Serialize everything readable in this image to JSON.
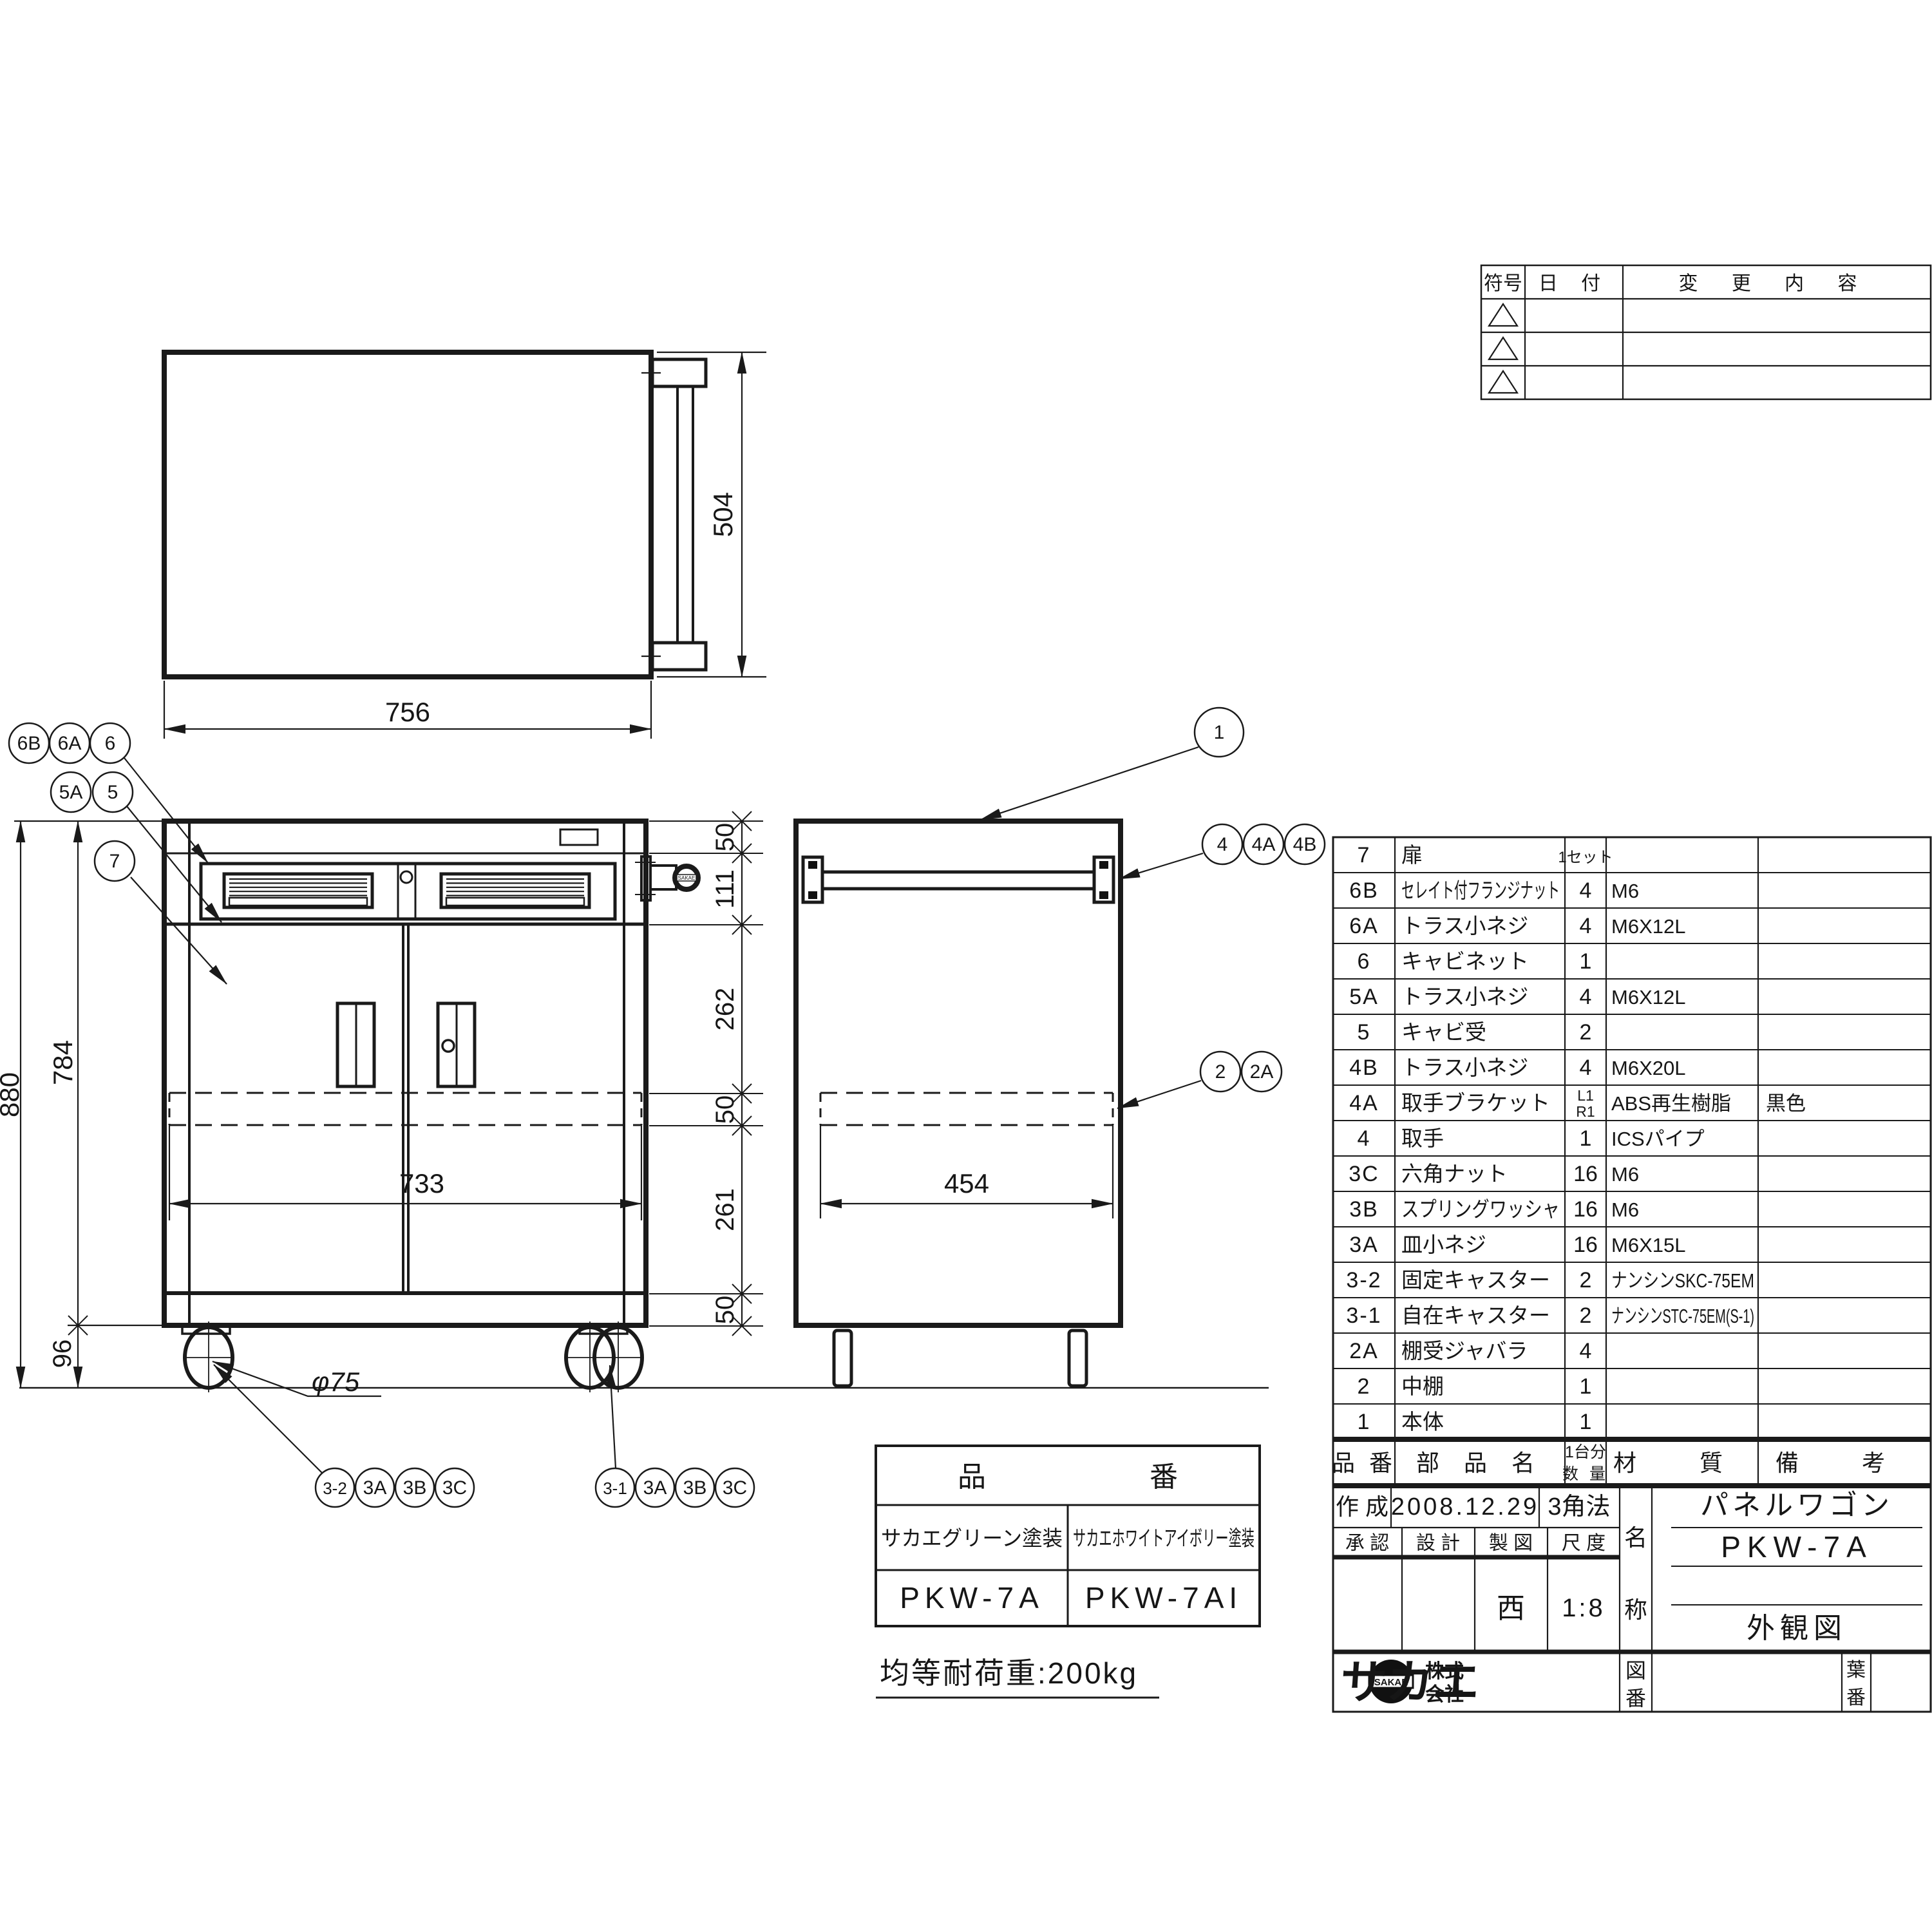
{
  "document": {
    "type": "engineering-drawing",
    "product_name": "パネルワゴン",
    "model": "PKW-7A",
    "sheet_title": "外観図"
  },
  "dimensions": {
    "top_width": "756",
    "top_depth": "504",
    "overall_height": "880",
    "body_height": "784",
    "caster_height": "96",
    "door_width": "733",
    "shelf_depth": "454",
    "caster_dia": "φ75",
    "right_chain": [
      "50",
      "111",
      "262",
      "50",
      "261",
      "50"
    ]
  },
  "callouts": [
    "6B",
    "6A",
    "6",
    "5A",
    "5",
    "7",
    "1",
    "4",
    "4A",
    "4B",
    "2",
    "2A",
    "3-2",
    "3A",
    "3B",
    "3C",
    "3-1",
    "3A",
    "3B",
    "3C"
  ],
  "revision_table": {
    "col_symbol": "符号",
    "col_date": "日 付",
    "col_change": "変 更 内 容",
    "empty_rows": 3
  },
  "parts_table": {
    "header": {
      "no": "品 番",
      "name": "部 品 名",
      "qty_line1": "1台分",
      "qty_line2": "数 量",
      "material": "材 質",
      "remarks": "備 考"
    },
    "rows": [
      {
        "no": "7",
        "name": "扉",
        "qty": "1セット",
        "material": "",
        "remarks": ""
      },
      {
        "no": "6B",
        "name": "セレイト付フランジナット",
        "qty": "4",
        "material": "M6",
        "remarks": ""
      },
      {
        "no": "6A",
        "name": "トラス小ネジ",
        "qty": "4",
        "material": "M6X12L",
        "remarks": ""
      },
      {
        "no": "6",
        "name": "キャビネット",
        "qty": "1",
        "material": "",
        "remarks": ""
      },
      {
        "no": "5A",
        "name": "トラス小ネジ",
        "qty": "4",
        "material": "M6X12L",
        "remarks": ""
      },
      {
        "no": "5",
        "name": "キャビ受",
        "qty": "2",
        "material": "",
        "remarks": ""
      },
      {
        "no": "4B",
        "name": "トラス小ネジ",
        "qty": "4",
        "material": "M6X20L",
        "remarks": ""
      },
      {
        "no": "4A",
        "name": "取手ブラケット",
        "qty": "L1 R1",
        "material": "ABS再生樹脂",
        "remarks": "黒色"
      },
      {
        "no": "4",
        "name": "取手",
        "qty": "1",
        "material": "ICSパイプ",
        "remarks": ""
      },
      {
        "no": "3C",
        "name": "六角ナット",
        "qty": "16",
        "material": "M6",
        "remarks": ""
      },
      {
        "no": "3B",
        "name": "スプリングワッシャ",
        "qty": "16",
        "material": "M6",
        "remarks": ""
      },
      {
        "no": "3A",
        "name": "皿小ネジ",
        "qty": "16",
        "material": "M6X15L",
        "remarks": ""
      },
      {
        "no": "3-2",
        "name": "固定キャスター",
        "qty": "2",
        "material": "ナンシンSKC-75EM",
        "remarks": ""
      },
      {
        "no": "3-1",
        "name": "自在キャスター",
        "qty": "2",
        "material": "ナンシンSTC-75EM(S-1)",
        "remarks": ""
      },
      {
        "no": "2A",
        "name": "棚受ジャバラ",
        "qty": "4",
        "material": "",
        "remarks": ""
      },
      {
        "no": "2",
        "name": "中棚",
        "qty": "1",
        "material": "",
        "remarks": ""
      },
      {
        "no": "1",
        "name": "本体",
        "qty": "1",
        "material": "",
        "remarks": ""
      }
    ]
  },
  "title_block": {
    "created_label": "作 成",
    "created_date": "2008.12.29",
    "projection": "3角法",
    "approval_label": "承 認",
    "design_label": "設 計",
    "drafting_label": "製 図",
    "scale_label": "尺 度",
    "drafter": "西",
    "scale": "1:8",
    "name_label_top": "名",
    "name_label_bottom": "称",
    "product_name": "パネルワゴン",
    "model": "PKW-7A",
    "sheet_title": "外観図",
    "company_line1": "株式",
    "company_line2": "会社",
    "company_name": "サカエ",
    "logo_text": "SAKAE",
    "dwg_no_top": "図",
    "dwg_no_bottom": "番",
    "sheet_no_top": "葉",
    "sheet_no_bottom": "番"
  },
  "product_table": {
    "header_left": "品",
    "header_right": "番",
    "finish_left": "サカエグリーン塗装",
    "finish_right": "サカエホワイトアイボリー塗装",
    "model_left": "PKW-7A",
    "model_right": "PKW-7AI"
  },
  "load_note": "均等耐荷重:200kg"
}
